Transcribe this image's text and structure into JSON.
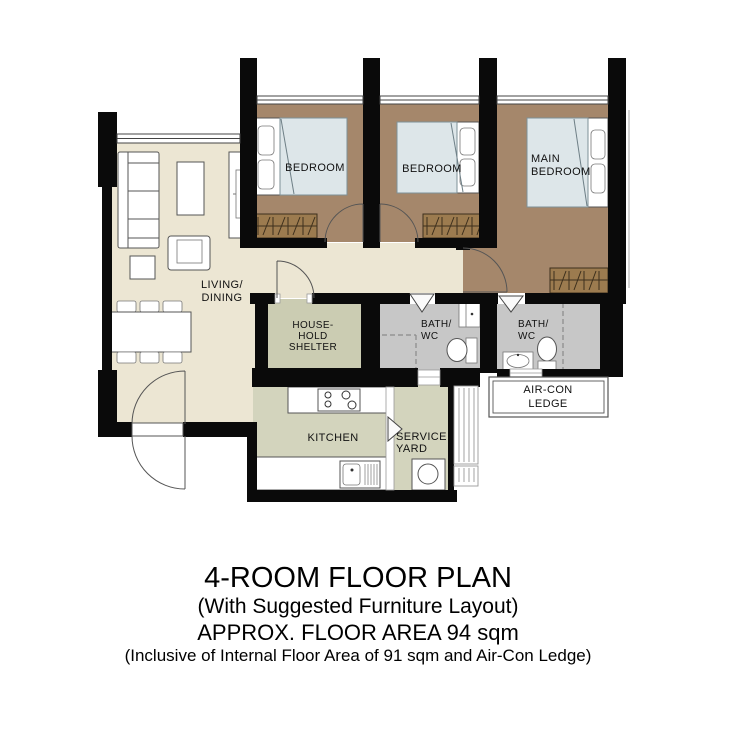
{
  "colors": {
    "wall": "#0a0a0a",
    "floor_living": "#ece6d3",
    "floor_bedroom": "#a5876b",
    "floor_shelter": "#cbccb2",
    "floor_bath": "#c7c7c7",
    "floor_kitchen": "#d3d4bd",
    "bed": "#dde6e9",
    "wardrobe": "#9c7b4f"
  },
  "rooms": {
    "living_dining": {
      "line1": "LIVING/",
      "line2": "DINING"
    },
    "bedroom1": {
      "label": "BEDROOM"
    },
    "bedroom2": {
      "label": "BEDROOM"
    },
    "main_bedroom": {
      "line1": "MAIN",
      "line2": "BEDROOM"
    },
    "household_shelter": {
      "line1": "HOUSE-",
      "line2": "HOLD",
      "line3": "SHELTER"
    },
    "bath1": {
      "line1": "BATH/",
      "line2": "WC"
    },
    "bath2": {
      "line1": "BATH/",
      "line2": "WC"
    },
    "kitchen": {
      "label": "KITCHEN"
    },
    "service_yard": {
      "line1": "SERVICE",
      "line2": "YARD"
    },
    "aircon_ledge": {
      "line1": "AIR-CON",
      "line2": "LEDGE"
    }
  },
  "title_block": {
    "title": "4-ROOM FLOOR PLAN",
    "subtitle": "(With Suggested Furniture Layout)",
    "area": "APPROX. FLOOR AREA 94 sqm",
    "note": "(Inclusive of Internal Floor Area of 91 sqm and Air-Con Ledge)"
  },
  "icons": [
    "bed-icon",
    "wardrobe-icon",
    "sofa-icon",
    "armchair-icon",
    "coffee-table-icon",
    "side-table-icon",
    "tv-console-icon",
    "dining-table-icon",
    "dining-chair-icon",
    "door-swing-icon",
    "folding-door-icon",
    "window-icon",
    "toilet-icon",
    "wash-basin-icon",
    "stove-icon",
    "kitchen-sink-icon",
    "washing-machine-icon",
    "drying-rack-icon",
    "aircon-ledge-box"
  ]
}
